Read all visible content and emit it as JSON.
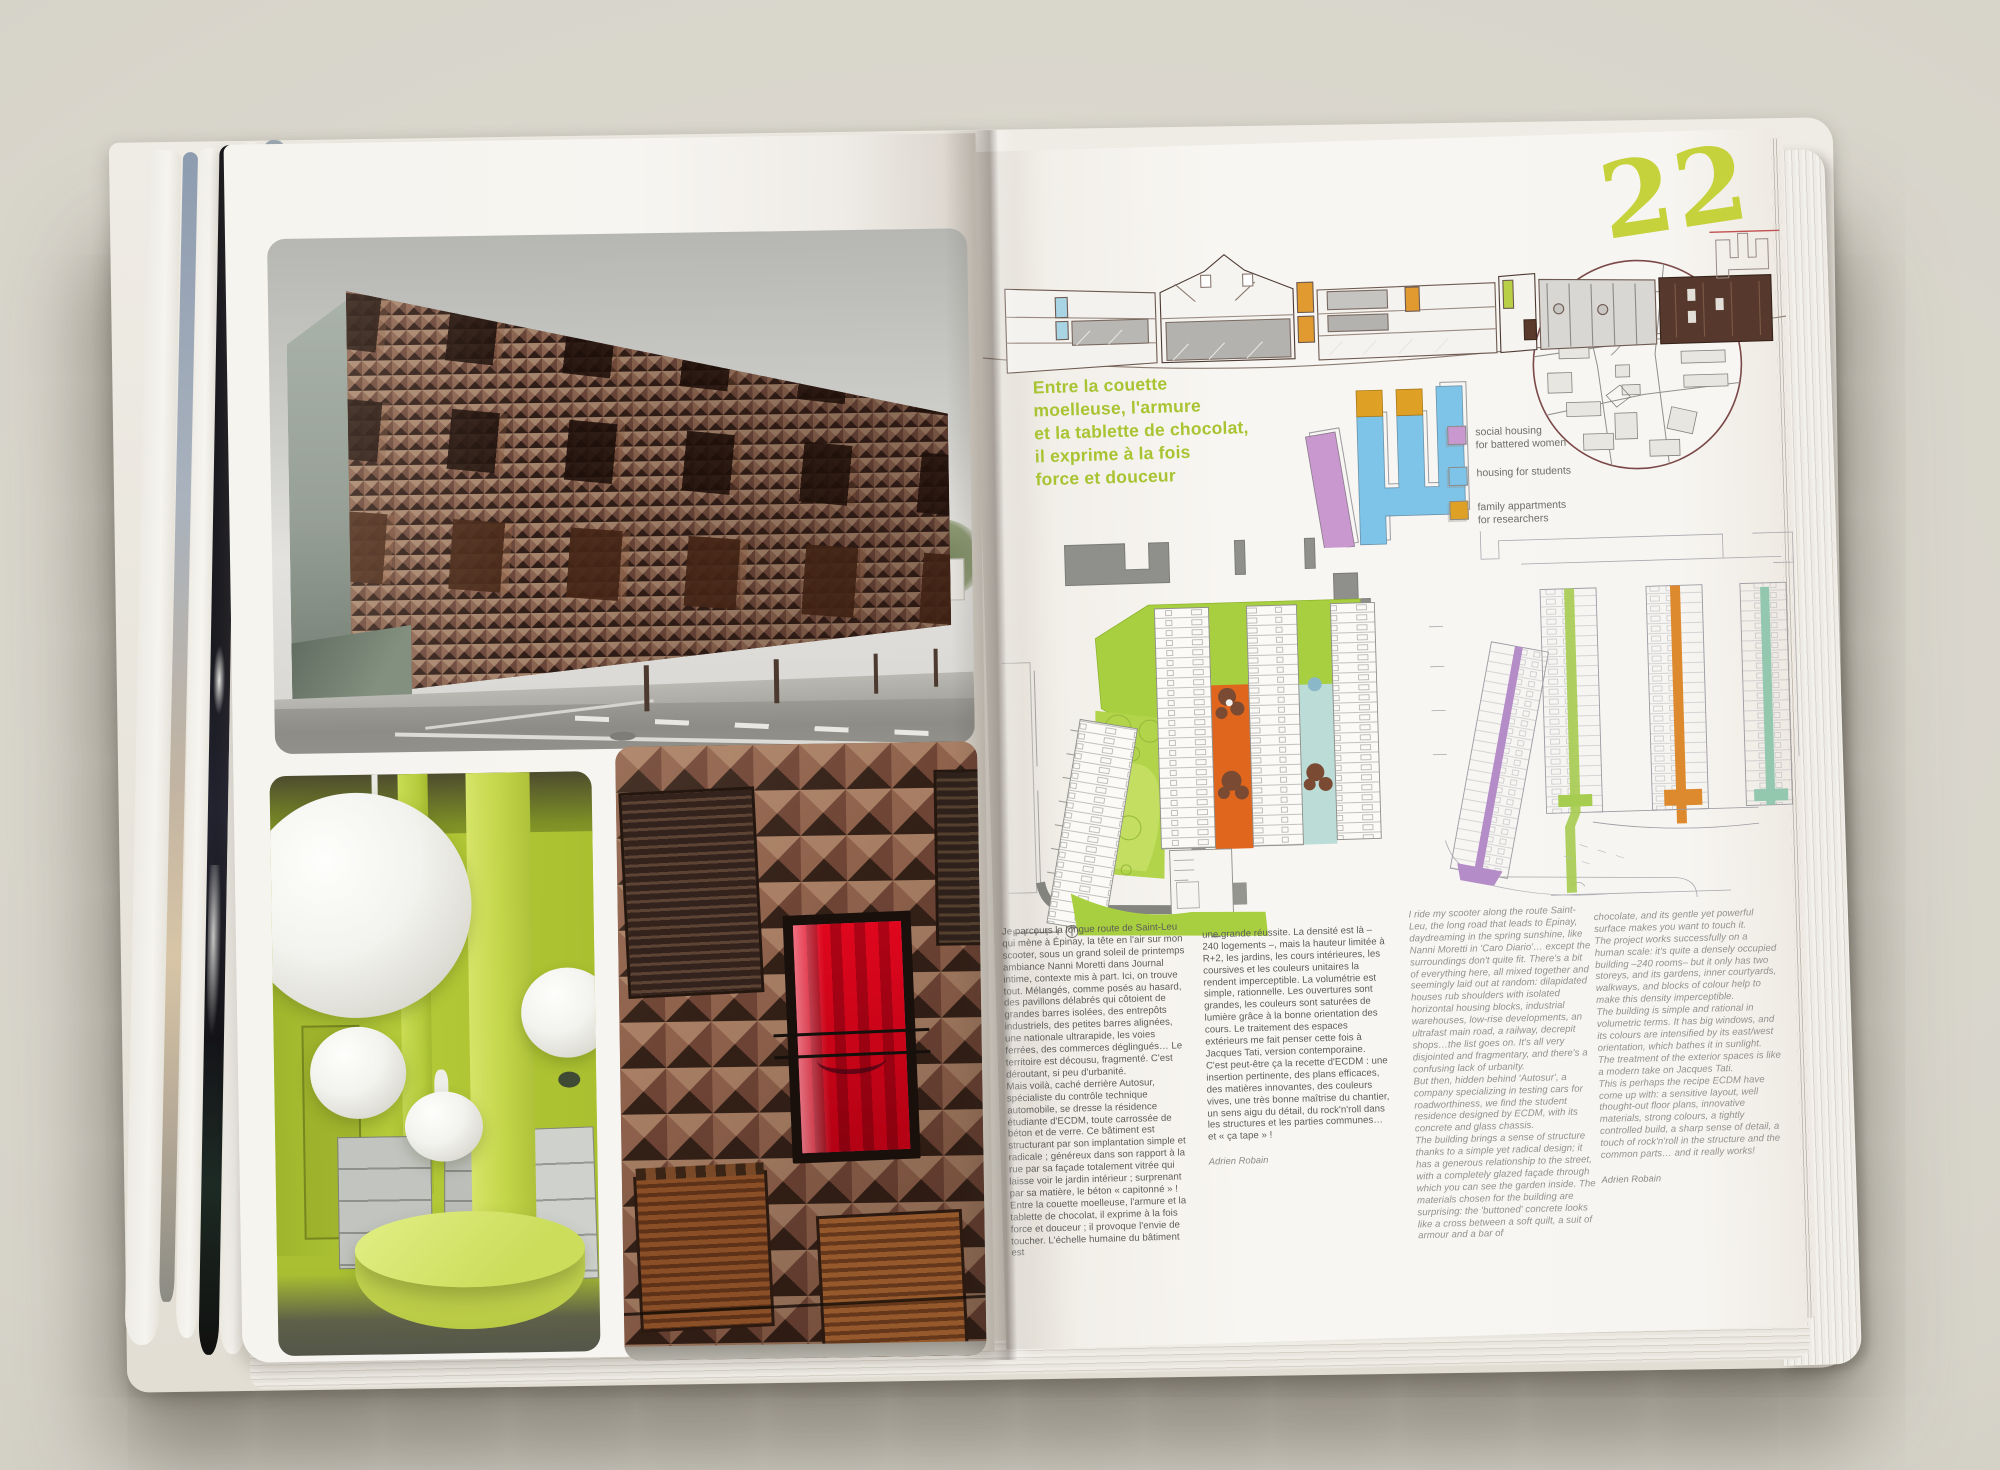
{
  "book": {
    "page_number": "22",
    "headline_fr": "Entre la couette\nmoelleuse, l'armure\net la tablette de chocolat,\nil exprime à la fois\nforce et douceur",
    "colors": {
      "accent_green": "#a9c433",
      "page_number_green": "#c6d23c",
      "legend_purple": "#c998cf",
      "legend_blue": "#7ec4e8",
      "legend_orange": "#dfa125",
      "plan_orange": "#e0661e",
      "plan_green": "#a8cf3f",
      "plan_blue_court": "#bcdcd8"
    },
    "legend": {
      "items": [
        {
          "label": "social housing\nfor battered women",
          "color": "#c998cf"
        },
        {
          "label": "housing for students",
          "color": "#7ec4e8"
        },
        {
          "label": "family appartments\nfor researchers",
          "color": "#dfa125"
        }
      ]
    },
    "columns": {
      "fr1": "Je parcours la longue route de Saint-Leu qui mène à Épinay, la tête en l'air sur mon scooter, sous un grand soleil de printemps ambiance Nanni Moretti dans Journal intime, contexte mis à part. Ici, on trouve tout. Mélangés, comme posés au hasard, des pavillons délabrés qui côtoient de grandes barres isolées, des entrepôts industriels, des petites barres alignées, une nationale ultrarapide, les voies ferrées, des commerces déglingués… Le territoire est décousu, fragmenté. C'est déroutant, si peu d'urbanité.\nMais voilà, caché derrière Autosur, spécialiste du contrôle technique automobile, se dresse la résidence étudiante d'ECDM, toute carrossée de béton et de verre. Ce bâtiment est structurant par son implantation simple et radicale ; généreux dans son rapport à la rue par sa façade totalement vitrée qui laisse voir le jardin intérieur ; surprenant par sa matière, le béton « capitonné » ! Entre la couette moelleuse, l'armure et la tablette de chocolat, il exprime à la fois force et douceur ; il provoque l'envie de toucher. L'échelle humaine du bâtiment est",
      "fr2": "une grande réussite. La densité est là – 240 logements –, mais la hauteur limitée à R+2, les jardins, les cours intérieures, les coursives et les couleurs unitaires la rendent imperceptible. La volumétrie est simple, rationnelle. Les ouvertures sont grandes, les couleurs sont saturées de lumière grâce à la bonne orientation des cours. Le traitement des espaces extérieurs me fait penser cette fois à Jacques Tati, version contemporaine.\nC'est peut-être ça la recette d'ECDM : une insertion pertinente, des plans efficaces, des matières innovantes, des couleurs vives, une très bonne maîtrise du chantier, un sens aigu du détail, du rock'n'roll dans les structures et les parties communes… et « ça tape » !",
      "fr2_byline": "Adrien Robain",
      "en1": "I ride my scooter along the route Saint-Leu, the long road that leads to Epinay, daydreaming in the spring sunshine, like Nanni Moretti in 'Caro Diario'… except the surroundings don't quite fit. There's a bit of everything here, all mixed together and seemingly laid out at random: dilapidated houses rub shoulders with isolated horizontal housing blocks, industrial warehouses, low-rise developments, an ultrafast main road, a railway, decrepit shops…the list goes on. It's all very disjointed and fragmentary, and there's a confusing lack of urbanity.\nBut then, hidden behind 'Autosur', a company specializing in testing cars for roadworthiness, we find the student residence designed by ECDM, with its concrete and glass chassis.\nThe building brings a sense of structure thanks to a simple yet radical design; it has a generous relationship to the street, with a completely glazed façade through which you can see the garden inside. The materials chosen for the building are surprising: the 'buttoned' concrete looks like a cross between a soft quilt, a suit of armour and a bar of",
      "en2": "chocolate, and its gentle yet powerful surface makes you want to touch it.\nThe project works successfully on a human scale: it's quite a densely occupied building –240 rooms– but it only has two storeys, and its gardens, inner courtyards, walkways, and blocks of colour help to make this density imperceptible.\nThe building is simple and rational in volumetric terms. It has big windows, and its colours are intensified by its east/west orientation, which bathes it in sunlight. The treatment of the exterior spaces is like a modern take on Jacques Tati.\nThis is perhaps the recipe ECDM have come up with: a sensitive layout, well thought-out floor plans, innovative materials, strong colours, a tightly controlled build, a sharp sense of detail, a touch of rock'n'roll in the structure and the common parts… and it really works!",
      "en2_byline": "Adrien Robain"
    }
  }
}
